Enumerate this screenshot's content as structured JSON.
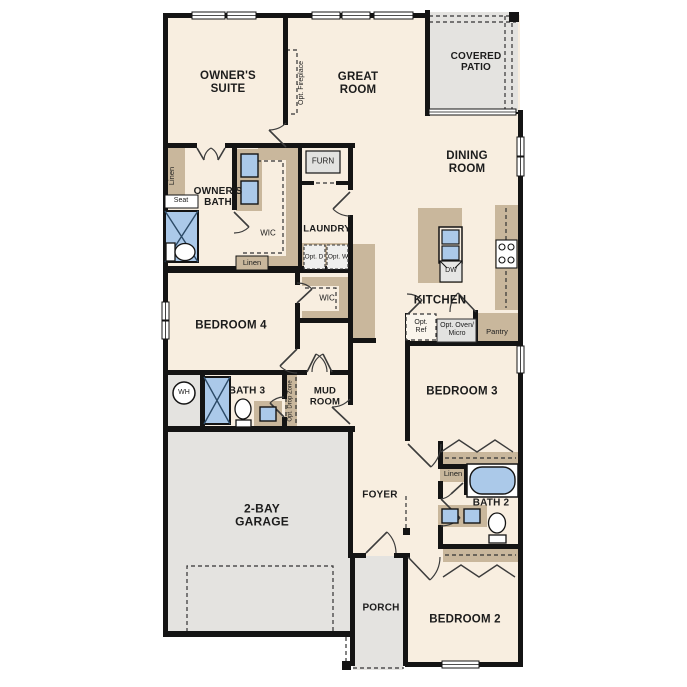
{
  "labels": {
    "owners_suite": "OWNER'S SUITE",
    "great_room": "GREAT ROOM",
    "covered_patio": "COVERED PATIO",
    "dining_room": "DINING ROOM",
    "owners_bath": "OWNER'S BATH",
    "laundry": "LAUNDRY",
    "kitchen": "KITCHEN",
    "bedroom_4": "BEDROOM 4",
    "bedroom_3": "BEDROOM 3",
    "bedroom_2": "BEDROOM 2",
    "bath_3": "BATH 3",
    "bath_2": "BATH 2",
    "mud_room": "MUD ROOM",
    "foyer": "FOYER",
    "porch": "PORCH",
    "garage": "2-BAY GARAGE",
    "wic_owners": "WIC",
    "wic_bedroom4": "WIC",
    "linen_owners_bath": "Linen",
    "linen_owners_wic": "Linen",
    "linen_bath2": "Linen",
    "seat": "Seat",
    "furnace": "FURN",
    "dishwasher": "DW",
    "water_heater": "WH",
    "opt_dryer": "Opt. D",
    "opt_washer": "Opt. W",
    "opt_refrigerator": "Opt. Ref",
    "opt_oven_micro": "Opt. Oven/ Micro",
    "pantry": "Pantry",
    "opt_fireplace": "Opt. Fireplace",
    "opt_drop_zone": "Opt. Drop Zone"
  },
  "colors": {
    "floor_interior": "#f8eee0",
    "floor_exterior": "#e4e3e0",
    "casework": "#c9b79c",
    "fixture_blue": "#abc9e9",
    "wall": "#141414"
  }
}
